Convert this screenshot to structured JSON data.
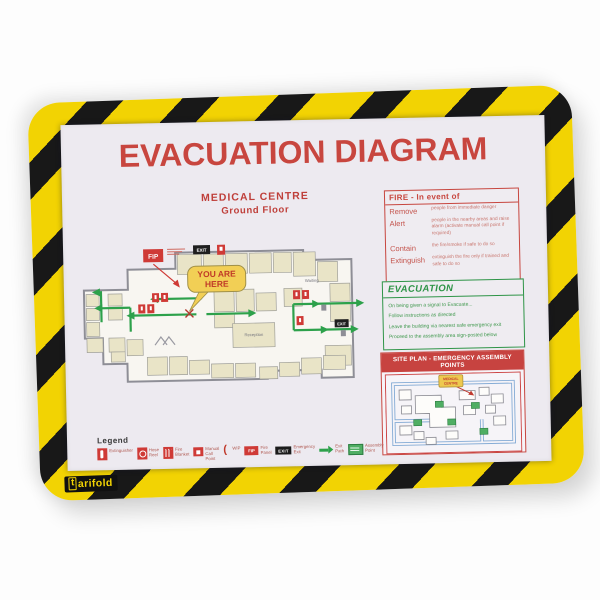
{
  "brand": {
    "logo_t": "t",
    "logo_suffix": "arifold"
  },
  "poster": {
    "title": "EVACUATION DIAGRAM",
    "medical_centre": "MEDICAL CENTRE",
    "ground_floor": "Ground Floor",
    "plan": {
      "you_are_here_line1": "YOU ARE",
      "you_are_here_line2": "HERE",
      "fip": "FIP",
      "exit": "EXIT",
      "waiting": "Waiting",
      "reception": "Reception"
    },
    "fire_box": {
      "title": "FIRE - In event of",
      "rows": [
        {
          "action": "Remove",
          "detail": "people from immediate danger"
        },
        {
          "action": "Alert",
          "detail": "people in the nearby areas and raise alarm (activate manual call point if required)"
        },
        {
          "action": "Contain",
          "detail": "the fire/smoke if safe to do so"
        },
        {
          "action": "Extinguish",
          "detail": "extinguish the fire only if trained and safe to do so"
        }
      ]
    },
    "evacuation_box": {
      "title": "EVACUATION",
      "lines": [
        "On being given a signal to Evacuate...",
        "Follow instructions as directed",
        "Leave the building via nearest safe emergency exit",
        "Proceed to the assembly area sign-posted below"
      ]
    },
    "site_plan_box": {
      "title": "SITE PLAN  -  EMERGENCY ASSEMBLY POINTS",
      "callout_line1": "MEDICAL",
      "callout_line2": "CENTRE"
    },
    "legend": {
      "title": "Legend",
      "items": [
        {
          "icon": "extinguisher-icon",
          "label": "Extinguisher"
        },
        {
          "icon": "hose-reel-icon",
          "label": "Hose Reel"
        },
        {
          "icon": "fire-blanket-icon",
          "label": "Fire Blanket"
        },
        {
          "icon": "manual-call-point-icon",
          "label": "Manual Call Point"
        },
        {
          "icon": "phone-icon",
          "label": "WIP"
        },
        {
          "icon": "fip-icon",
          "icon_text": "FIP",
          "label": "Fire Panel"
        },
        {
          "icon": "exit-sign-icon",
          "icon_text": "EXIT",
          "label": "Emergency Exit"
        },
        {
          "icon": "exit-path-icon",
          "label": "Exit Path"
        },
        {
          "icon": "assembly-point-icon",
          "label": "Assembly Point"
        }
      ]
    }
  },
  "colors": {
    "frame_yellow": "#f2d303",
    "frame_black": "#181818",
    "paper": "#edeaf0",
    "red": "#c7463f",
    "green": "#2e9447",
    "map_blue": "#84abd5"
  }
}
